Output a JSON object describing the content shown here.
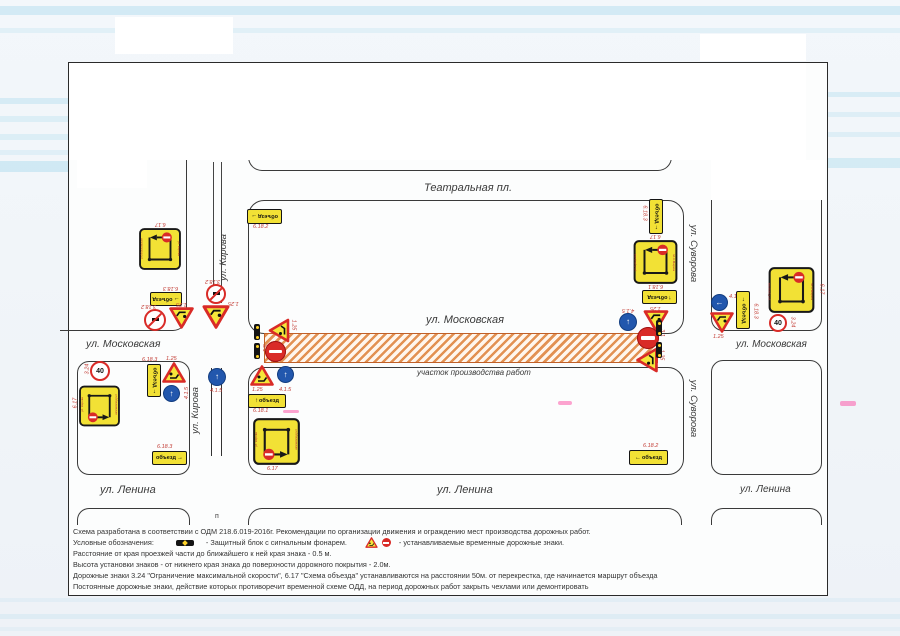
{
  "labels": {
    "teatralnaya": "Театральная пл.",
    "moskovskaya": "ул. Московская",
    "lenina": "ул. Ленина",
    "kirova": "ул. Кирова",
    "suvorova": "ул. Суворова",
    "work_zone": "участок производства работ",
    "artifact": "п"
  },
  "signs": {
    "detour": "объезд",
    "speed_value": "40",
    "codes": {
      "c617": "6.17",
      "c6181": "6.18.1",
      "c6182": "6.18.2",
      "c6183": "6.18.3",
      "c125": "1.25",
      "c31": "3.1",
      "c324": "3.24",
      "c3182": "3.18.2",
      "c413": "4.1.3",
      "c415": "4.1.5"
    },
    "scheme_streets": {
      "kirova": "ул. Кирова",
      "moskovskaya": "ул.Московская",
      "k_marksa": "пл.К.Маркса",
      "suvorova": "ул.Суворова"
    }
  },
  "legend": {
    "line1": "Схема разработана в соответствии с ОДМ 218.6.019-2016г. Рекомендации по организации движения и ограждению мест производства дорожных работ.",
    "line2_prefix": "Условные обозначения:",
    "line2_block": "- Защитный блок с сигнальным фонарем.",
    "line2_signs": "- устанавливаемые временные дорожные знаки.",
    "line3": "Расстояние от края проезжей части до ближайшего к ней края знака - 0.5 м.",
    "line4": "Высота установки знаков -  от нижнего края знака до поверхности дорожного покрытия - 2.0м.",
    "line5": "Дорожные знаки 3.24 \"Ограничение максимальной скорости\", 6.17 \"Схема объезда\" устанавливаются на расстоянии 50м. от перекрестка, где начинается маршрут объезда",
    "line6": "Постоянные дорожные знаки, действие которых противоречит временной схеме ОДД, на период дорожных работ закрыть чехлами или демонтировать"
  },
  "colors": {
    "sign_yellow": "#f2e135",
    "sign_red": "#d92b27",
    "sign_blue": "#2257ad",
    "work_zone_orange": "#dc7628",
    "scan_cyan": "#8fd0e8"
  }
}
